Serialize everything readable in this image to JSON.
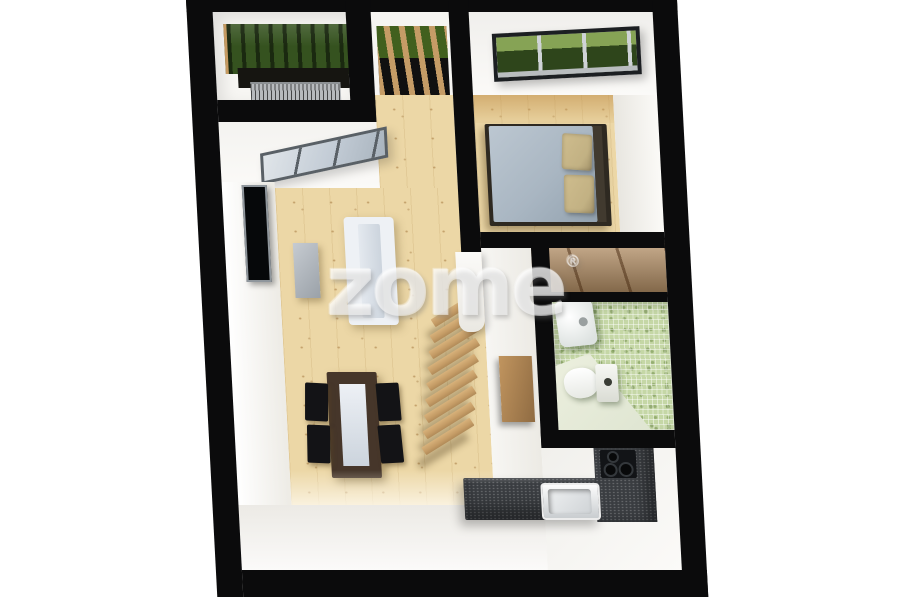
{
  "watermark": {
    "brand": "zome",
    "registered_mark": "®"
  },
  "colors": {
    "background": "#ffffff",
    "wall": "#0b0b0c",
    "wood-floor": "#ecd7a6",
    "wood-accent": "#c59c66",
    "plant-green": "#35521f",
    "window-glass": "#c3ccd6",
    "duvet": "#a9b6c2",
    "pillow": "#c2b183",
    "sofa": "#eef1f5",
    "table-wood": "#46362a",
    "chair": "#131316",
    "mosaic": "#c5d7a6",
    "counter": "#3a3d41",
    "grate": "#b7babd",
    "watermark": "rgba(255,255,255,0.52)"
  },
  "scene": {
    "view": "top-down-3d-floorplan",
    "rooms": [
      {
        "name": "balcony-garden",
        "items": [
          "vertical-plant-bed",
          "floor-grate"
        ]
      },
      {
        "name": "entrance",
        "items": [
          "wood-louver-screen"
        ]
      },
      {
        "name": "bedroom",
        "items": [
          "window-with-greenery",
          "double-bed",
          "duvet",
          "pillows",
          "headboard"
        ]
      },
      {
        "name": "living-room",
        "items": [
          "large-window",
          "tv",
          "sideboard",
          "sofa",
          "dining-table",
          "table-runner",
          "four-chairs",
          "floating-stairs"
        ]
      },
      {
        "name": "corridor",
        "items": [
          "wood-panel",
          "wardrobe-shelving"
        ]
      },
      {
        "name": "bathroom",
        "items": [
          "mosaic-tile-walls",
          "washbasin",
          "toilet"
        ]
      },
      {
        "name": "kitchen",
        "items": [
          "l-shaped-counter",
          "sink",
          "cooktop-burners"
        ]
      }
    ]
  }
}
